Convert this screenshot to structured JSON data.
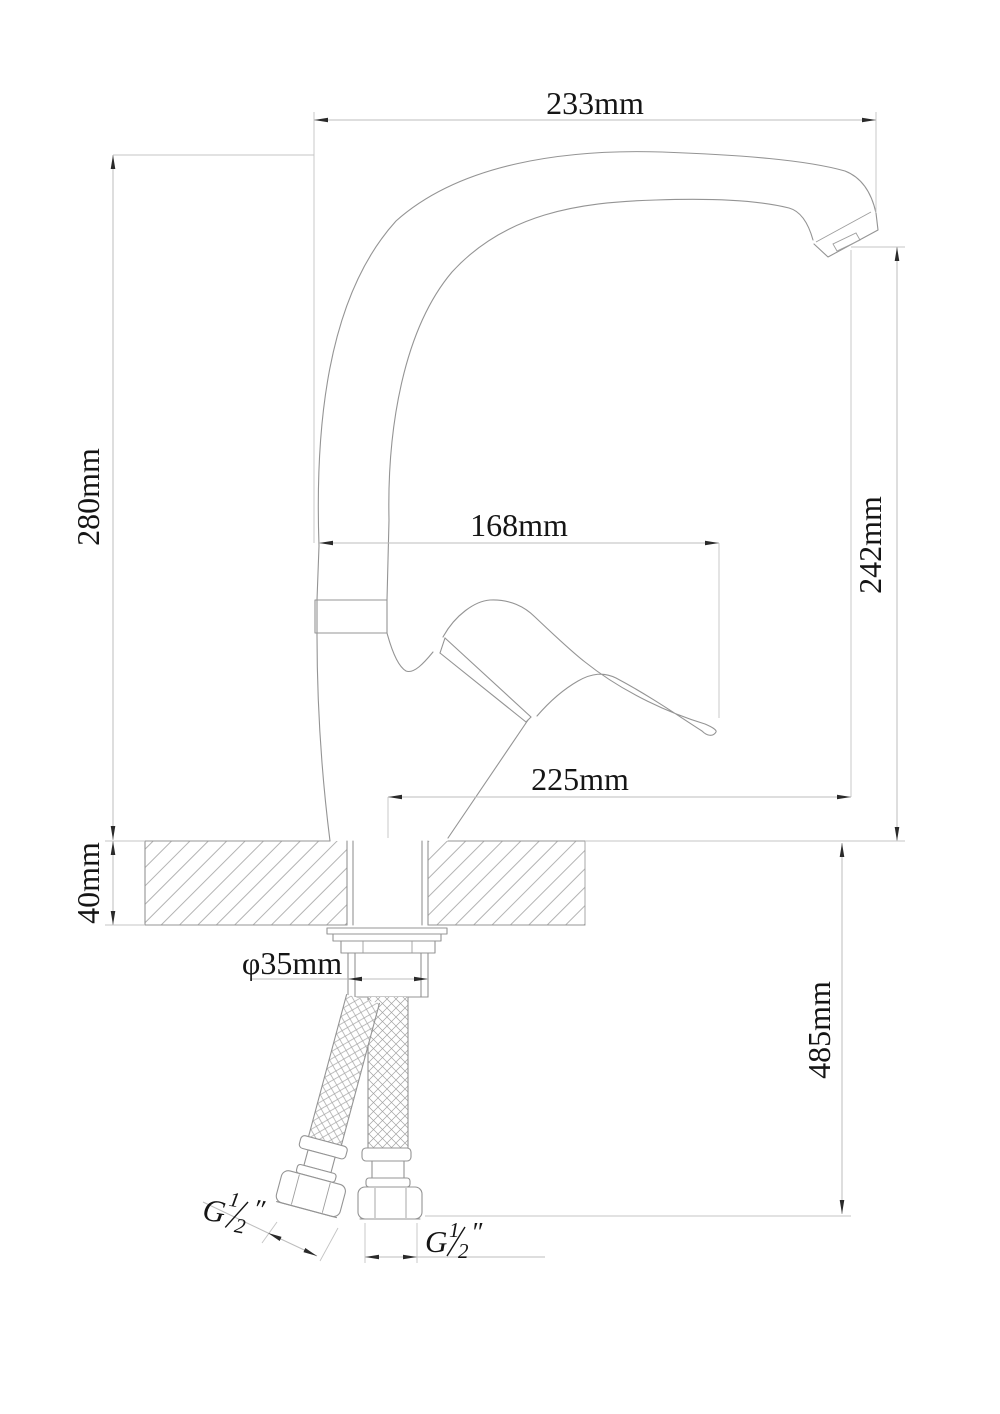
{
  "dimensions": {
    "spout_reach": "233mm",
    "overall_height": "280mm",
    "outlet_height": "242mm",
    "handle_reach": "168mm",
    "tip_to_body": "225mm",
    "deck_thickness": "40mm",
    "mounting_hole": "φ35mm",
    "hose_drop": "485mm"
  },
  "threads": {
    "left": {
      "g": "G",
      "numerator": "1",
      "denominator": "2",
      "inches": "″"
    },
    "right": {
      "g": "G",
      "numerator": "1",
      "denominator": "2",
      "inches": "″"
    }
  },
  "colors": {
    "background": "#ffffff",
    "object_line": "#949494",
    "dimension_line": "#bdbdbd",
    "text": "#151515"
  }
}
